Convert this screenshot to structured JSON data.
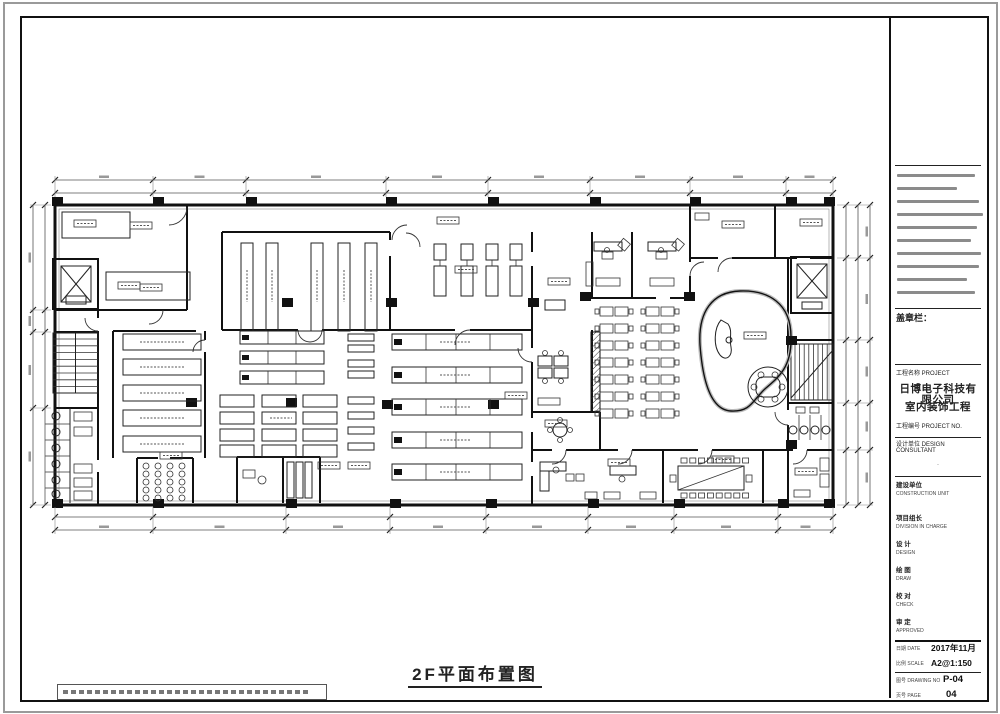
{
  "document": {
    "drawing_title": "2F平面布置图"
  },
  "title_block": {
    "seal_label": "盖章栏：",
    "project_label": "工程名称 PROJECT",
    "company_name": "日博电子科技有限公司",
    "project_name": "室内装饰工程",
    "project_no_label": "工程编号 PROJECT NO.",
    "design_unit_label": "设计单位 DESIGN CONSULTANT",
    "build_label": "建设单位",
    "build_sub": "CONSTRUCTION UNIT",
    "roles": [
      {
        "label": "项目组长",
        "sub": "DIVISION IN CHARGE"
      },
      {
        "label": "设 计",
        "sub": "DESIGN"
      },
      {
        "label": "绘 图",
        "sub": "DRAW"
      },
      {
        "label": "校 对",
        "sub": "CHECK"
      },
      {
        "label": "审 定",
        "sub": "APPROVED"
      }
    ],
    "meta": [
      {
        "label": "日期 DATE",
        "value": "2017年11月"
      },
      {
        "label": "比例 SCALE",
        "value": "A2@1:150"
      },
      {
        "label": "图号 DRAWING NO",
        "value": "P-04"
      },
      {
        "label": "页号 PAGE",
        "value": "04"
      }
    ]
  }
}
